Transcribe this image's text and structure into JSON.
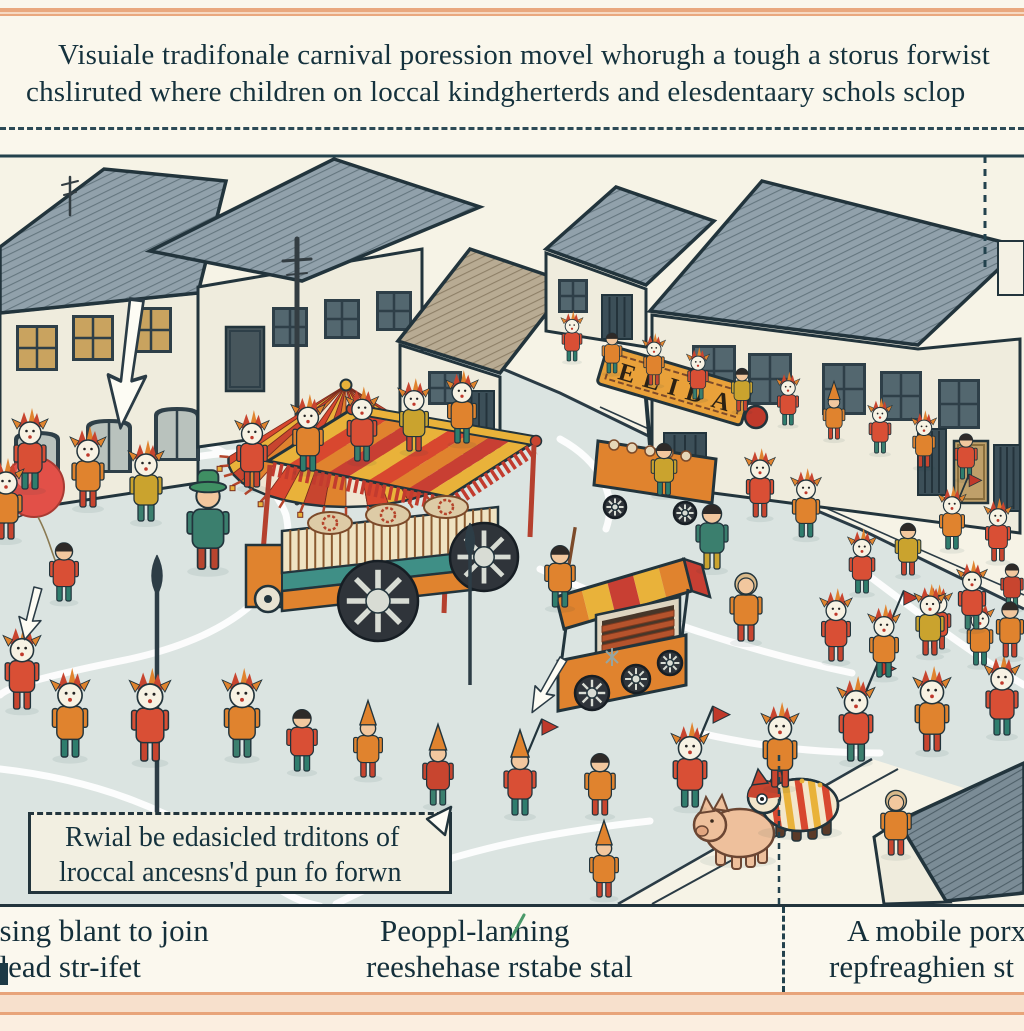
{
  "top_caption": {
    "line1": "Visuiale tradifonale carnival poression  movel whorugh a tough a storus forwist",
    "line2": "chsliruted where children on loccal kindgherterds and elesdentaary schols sclop"
  },
  "note_box": {
    "line1": "Rwial be edasicled trditons of",
    "line2": "lroccal ancesns'd pun fo forwn"
  },
  "bottom_captions": [
    {
      "line1": "osing blant to join",
      "line2": "olead str-ifet"
    },
    {
      "line1": "Peoppl-lanning",
      "line2": "reeshehase rstabe stal"
    },
    {
      "line1": "A mobile porxk",
      "line2": "repfreaghien st"
    }
  ],
  "colors": {
    "border_peach": "#e9a87e",
    "paper": "#faf7ec",
    "ink": "#22343c",
    "road": "#dbe4e1",
    "sidewalk": "#f6f3e6",
    "roof": "#91a1ab",
    "roof_taupe": "#b8ab93",
    "wall": "#efecdd",
    "awning_red": "#d8472f",
    "awning_orange": "#e0832e",
    "awning_yellow": "#e9b23a",
    "costume_red": "#d94f35",
    "teal": "#3b7f6e"
  },
  "scene": {
    "banner_text": "ELIDA",
    "elements": [
      "town-buildings",
      "street",
      "carnival-umbrella-canopy",
      "festival-float-cart",
      "banner-cart",
      "snack-grill-cart",
      "parade-children",
      "costumed-mask-figures",
      "pink-pig",
      "decorated-pig",
      "red-balloon",
      "white-arrows",
      "spear-poles",
      "utility-pole"
    ],
    "buildings": [
      {
        "roof": "0,238 104,160 226,172 198,284 0,304",
        "wall": "0,304 198,284 198,474 0,504",
        "roofFill": "ribs",
        "items": [
          [
            16,
            316,
            42,
            46,
            "tan"
          ],
          [
            72,
            306,
            42,
            46,
            "tan"
          ],
          [
            130,
            298,
            42,
            46,
            "tan"
          ],
          [
            14,
            422,
            46,
            54,
            "arch"
          ],
          [
            86,
            410,
            46,
            54,
            "arch"
          ],
          [
            154,
            398,
            46,
            54,
            "arch"
          ]
        ]
      },
      {
        "roof": "150,242 334,150 480,198 302,272",
        "wall": "198,278 422,240 422,406 198,438",
        "roofFill": "ribs",
        "items": [
          [
            272,
            298,
            36,
            40,
            "dark"
          ],
          [
            324,
            290,
            36,
            40,
            "dark"
          ],
          [
            376,
            282,
            36,
            40,
            "dark"
          ],
          [
            226,
            318,
            38,
            64,
            "door-dark"
          ]
        ]
      },
      {
        "roof": "398,332 470,240 570,274 500,364",
        "wall": "400,336 500,368 500,448 400,462",
        "roofFill": "ribsT",
        "items": [
          [
            428,
            362,
            34,
            34,
            "dark"
          ],
          [
            464,
            382,
            30,
            62,
            "slat"
          ]
        ]
      },
      {
        "roof": "546,240 616,178 714,212 646,276",
        "wall": "546,244 646,280 646,338 546,322",
        "roofFill": "ribs",
        "items": [
          [
            558,
            270,
            30,
            34,
            "dark"
          ],
          [
            602,
            286,
            30,
            44,
            "slat"
          ]
        ]
      },
      {
        "roof": "650,302 762,172 1022,238 918,336",
        "wall": "652,306 918,340 1020,330 1020,524 652,476",
        "roofFill": "ribs",
        "items": [
          [
            692,
            336,
            44,
            52,
            "dark"
          ],
          [
            748,
            344,
            44,
            52,
            "dark"
          ],
          [
            822,
            354,
            44,
            52,
            "dark"
          ],
          [
            880,
            362,
            42,
            50,
            "dark"
          ],
          [
            938,
            370,
            42,
            50,
            "dark"
          ],
          [
            664,
            424,
            42,
            62,
            "slat"
          ],
          [
            918,
            420,
            28,
            66,
            "slat"
          ],
          [
            954,
            432,
            34,
            62,
            "door-tan"
          ],
          [
            994,
            436,
            26,
            66,
            "slat"
          ]
        ]
      },
      {
        "roof": "898,812 1024,754 1024,884 946,892",
        "wall": "874,828 902,810 950,893 884,895",
        "roofFill": "ribsD",
        "items": []
      }
    ],
    "figures": [
      [
        572,
        352,
        0.62,
        "mask",
        "#d94f35",
        "#2f7d6d",
        ""
      ],
      [
        612,
        364,
        0.62,
        "hair",
        "#e0832e",
        "#2f7d6d",
        ""
      ],
      [
        654,
        376,
        0.64,
        "mask",
        "#e0832e",
        "#c8452f",
        ""
      ],
      [
        698,
        390,
        0.64,
        "mask",
        "#d94f35",
        "#3b7f6e",
        ""
      ],
      [
        742,
        402,
        0.66,
        "hair",
        "#caa32e",
        "#c8452f",
        ""
      ],
      [
        788,
        416,
        0.66,
        "mask",
        "#d94f35",
        "#2f7d6d",
        ""
      ],
      [
        834,
        430,
        0.68,
        "cone",
        "#e0832e",
        "#c8452f",
        ""
      ],
      [
        880,
        444,
        0.68,
        "mask",
        "#d94f35",
        "#3b7f6e",
        ""
      ],
      [
        924,
        458,
        0.7,
        "mask",
        "#e0832e",
        "#c8452f",
        ""
      ],
      [
        966,
        470,
        0.7,
        "hair",
        "#d94f35",
        "#2f7d6d",
        ""
      ],
      [
        938,
        640,
        0.8,
        "mask",
        "#d94f35",
        "#c8452f",
        ""
      ],
      [
        980,
        656,
        0.8,
        "mask",
        "#e0832e",
        "#2f7d6d",
        ""
      ],
      [
        1012,
        600,
        0.7,
        "hair",
        "#c8452f",
        "#3b7f6e",
        ""
      ],
      [
        30,
        480,
        1.0,
        "mask",
        "#d94f35",
        "#2f7d6d",
        ""
      ],
      [
        88,
        498,
        1.0,
        "mask",
        "#e0832e",
        "#c8452f",
        ""
      ],
      [
        146,
        512,
        1.0,
        "mask",
        "#caa32e",
        "#3b7f6e",
        ""
      ],
      [
        252,
        478,
        0.95,
        "mask",
        "#d94f35",
        "#c8452f",
        ""
      ],
      [
        308,
        462,
        0.95,
        "mask",
        "#e0832e",
        "#2f7d6d",
        ""
      ],
      [
        362,
        452,
        0.92,
        "mask",
        "#d94f35",
        "#3b7f6e",
        ""
      ],
      [
        414,
        442,
        0.9,
        "mask",
        "#caa32e",
        "#c8452f",
        ""
      ],
      [
        462,
        434,
        0.9,
        "mask",
        "#e0832e",
        "#2f7d6d",
        ""
      ],
      [
        6,
        530,
        1.0,
        "mask",
        "#e0832e",
        "#c8452f",
        ""
      ],
      [
        208,
        560,
        1.3,
        "green",
        "#3b7f6e",
        "#b8452f",
        ""
      ],
      [
        64,
        592,
        0.9,
        "hair",
        "#d94f35",
        "#2f7d6d",
        ""
      ],
      [
        560,
        598,
        0.95,
        "hair",
        "#e0832e",
        "#2f7d6d",
        "stick"
      ],
      [
        712,
        560,
        1.0,
        "hair",
        "#3b7f6e",
        "#caa32e",
        ""
      ],
      [
        746,
        632,
        1.0,
        "monk",
        "#e0832e",
        "#c8452f",
        ""
      ],
      [
        664,
        486,
        0.8,
        "hair",
        "#caa32e",
        "#2f7d6d",
        ""
      ],
      [
        760,
        508,
        0.85,
        "mask",
        "#d94f35",
        "#c8452f",
        ""
      ],
      [
        806,
        528,
        0.85,
        "mask",
        "#e0832e",
        "#2f7d6d",
        ""
      ],
      [
        22,
        700,
        1.05,
        "mask",
        "#d94f35",
        "#c8452f",
        ""
      ],
      [
        70,
        748,
        1.1,
        "mask",
        "#e0832e",
        "#2f7d6d",
        ""
      ],
      [
        150,
        752,
        1.15,
        "mask",
        "#d94f35",
        "#c8452f",
        ""
      ],
      [
        242,
        748,
        1.1,
        "mask",
        "#e0832e",
        "#3b7f6e",
        ""
      ],
      [
        302,
        762,
        0.95,
        "hair",
        "#d94f35",
        "#2f7d6d",
        ""
      ],
      [
        368,
        768,
        0.9,
        "cone",
        "#e0832e",
        "#c8452f",
        ""
      ],
      [
        438,
        796,
        0.95,
        "cone",
        "#c8452f",
        "#3b7f6e",
        ""
      ],
      [
        520,
        806,
        1.0,
        "cone",
        "#d94f35",
        "#2f7d6d",
        "flag"
      ],
      [
        600,
        806,
        0.95,
        "hair",
        "#e0832e",
        "#c8452f",
        ""
      ],
      [
        690,
        798,
        1.05,
        "mask",
        "#d94f35",
        "#2f7d6d",
        "flag"
      ],
      [
        780,
        778,
        1.05,
        "mask",
        "#e0832e",
        "#c8452f",
        ""
      ],
      [
        856,
        752,
        1.05,
        "mask",
        "#d94f35",
        "#3b7f6e",
        "flag"
      ],
      [
        932,
        742,
        1.05,
        "mask",
        "#e0832e",
        "#c8452f",
        ""
      ],
      [
        1002,
        726,
        1.0,
        "mask",
        "#d94f35",
        "#2f7d6d",
        ""
      ],
      [
        836,
        652,
        0.9,
        "mask",
        "#d94f35",
        "#c8452f",
        ""
      ],
      [
        884,
        668,
        0.9,
        "mask",
        "#e0832e",
        "#2f7d6d",
        "flag"
      ],
      [
        930,
        646,
        0.88,
        "mask",
        "#caa32e",
        "#c8452f",
        ""
      ],
      [
        972,
        620,
        0.85,
        "mask",
        "#d94f35",
        "#3b7f6e",
        ""
      ],
      [
        1010,
        648,
        0.85,
        "hair",
        "#e0832e",
        "#c8452f",
        ""
      ],
      [
        862,
        584,
        0.8,
        "mask",
        "#d94f35",
        "#2f7d6d",
        ""
      ],
      [
        908,
        566,
        0.8,
        "hair",
        "#caa32e",
        "#c8452f",
        ""
      ],
      [
        952,
        540,
        0.78,
        "mask",
        "#e0832e",
        "#2f7d6d",
        "flag"
      ],
      [
        998,
        552,
        0.78,
        "mask",
        "#d94f35",
        "#c8452f",
        ""
      ],
      [
        896,
        846,
        0.95,
        "monk",
        "#e0832e",
        "#c8452f",
        ""
      ],
      [
        604,
        888,
        0.9,
        "cone",
        "#e0832e",
        "#c8452f",
        ""
      ]
    ]
  }
}
